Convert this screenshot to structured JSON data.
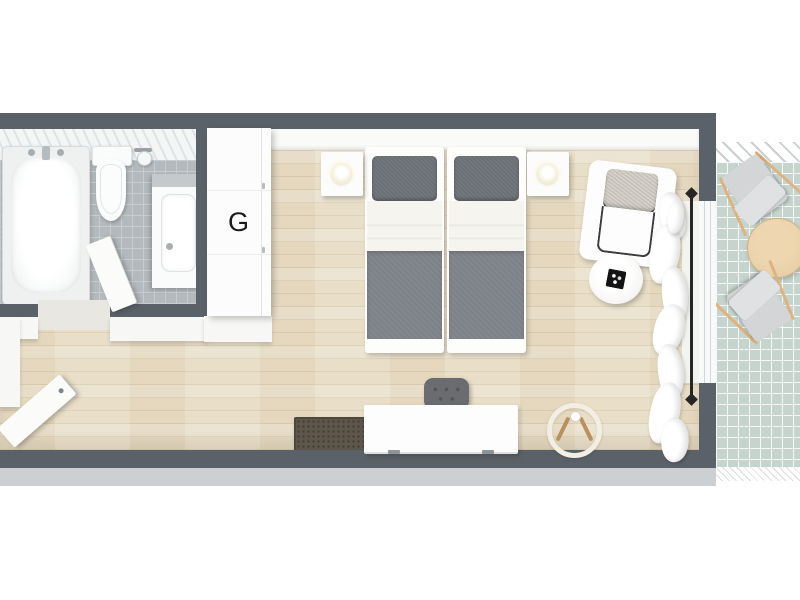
{
  "scene": {
    "type": "3d-floorplan-top-view",
    "wardrobe_label": "G"
  },
  "rooms": [
    {
      "name": "bathroom"
    },
    {
      "name": "bedroom"
    },
    {
      "name": "hallway"
    },
    {
      "name": "balcony"
    }
  ],
  "furniture": [
    "bathtub",
    "toilet",
    "toilet-paper-holder",
    "sink-vanity",
    "bathroom-door",
    "wardrobe",
    "twin-bed-left",
    "twin-bed-right",
    "nightstand-left",
    "nightstand-right",
    "table-lamp-left",
    "table-lamp-right",
    "armchair",
    "side-table-with-tray",
    "desk",
    "desk-chair",
    "door-mat",
    "ring-floor-lamp",
    "curtains",
    "curtain-rod",
    "entry-door",
    "balcony-round-table",
    "balcony-lounge-chair-top",
    "balcony-lounge-chair-bottom"
  ],
  "colors": {
    "wall": "#5a6168",
    "wall_face": "#cdd0d2",
    "wood": "#e9dfc9",
    "bath_tile": "#b3b9bc",
    "bath_grout": "#c7ccce",
    "balcony_tile": "#c6d4ce",
    "blanket": "#7d8287",
    "pillow": "#6b7075",
    "sheet": "#f5f4ef",
    "cushion": "#c7c2b9",
    "mat": "#5e564b",
    "desk_chair": "#6b6c6f",
    "wood_accent": "#b8915f",
    "balcony_table": "#e7cfa8",
    "balcony_chair": "#d4d5d7",
    "rod": "#262626"
  }
}
